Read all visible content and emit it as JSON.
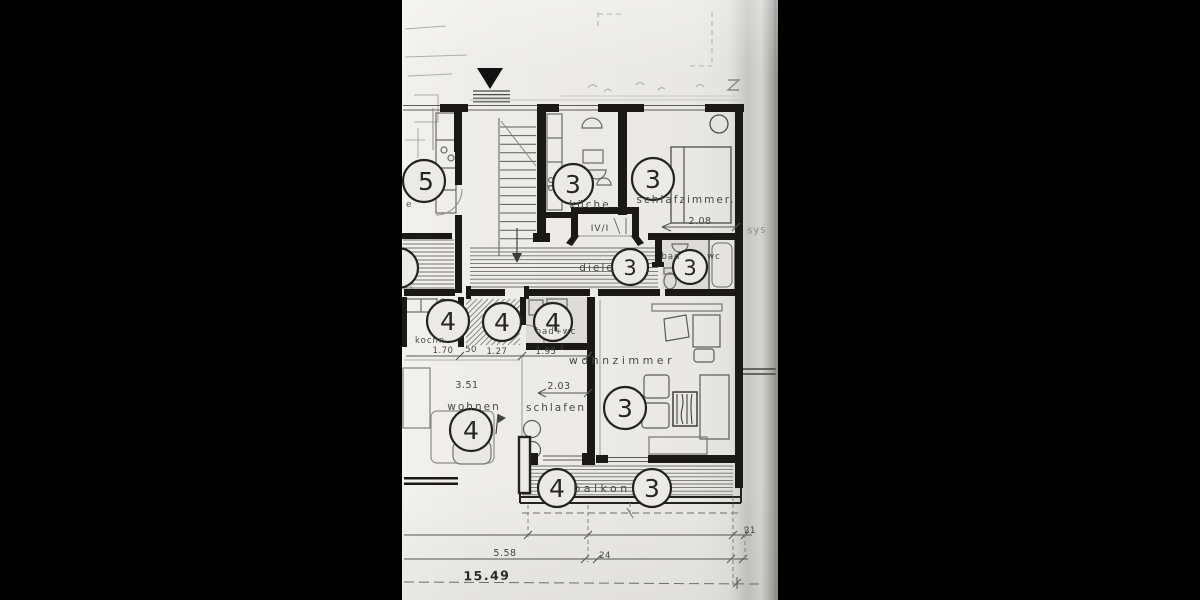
{
  "document": {
    "kind": "scanned architectural floor plan",
    "language": "German"
  },
  "rooms": {
    "kueche": {
      "label": "küche",
      "unit": "3"
    },
    "schlafzimmer": {
      "label": "schlafzimmer.",
      "unit": "3"
    },
    "diele": {
      "label": "diele",
      "unit": "3"
    },
    "bad_wc_3": {
      "label_left": "bad",
      "label_right": "wc",
      "unit": "3"
    },
    "wohnzimmer": {
      "label": "wohnzimmer",
      "unit": "3"
    },
    "balkon": {
      "label": "balkon",
      "unit_left": "4",
      "unit_right": "3"
    },
    "kochnische": {
      "label": "kochn.",
      "unit": "4"
    },
    "flur_4": {
      "unit": "4"
    },
    "bad_wc_4": {
      "label": "bad+wc",
      "unit": "4"
    },
    "wohnen": {
      "label": "wohnen",
      "unit": "4"
    },
    "schlafen": {
      "label": "schlafen"
    },
    "neighbor": {
      "unit": "5",
      "fragment": "e"
    }
  },
  "annotations": {
    "entrance_code": "IV/I",
    "margin_note": "sys"
  },
  "dimensions": {
    "w_kochnische": "1.70",
    "w_small": "50",
    "w_flur": "1.27",
    "w_bad": "1.95",
    "w_bad_sup": "5",
    "w_wohnen": "3.51",
    "w_schlafen": "2.03",
    "w_schlafzimmer": "2.08",
    "total_left": "5.58",
    "gap_mid": "24",
    "gap_right": "21",
    "total_length": "15.49"
  }
}
